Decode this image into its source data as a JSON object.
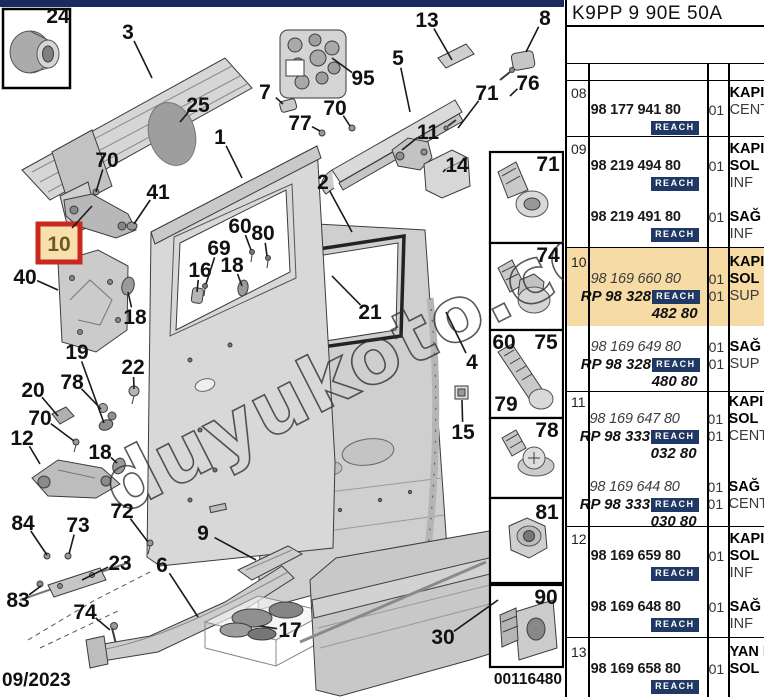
{
  "header": {
    "title": "K9PP 9 90E 50A"
  },
  "footer": {
    "date": "09/2023",
    "doc_number": "00116480"
  },
  "watermark": {
    "text": "duyukoto.com"
  },
  "badge": {
    "label": "REACH",
    "bg": "#1f3864",
    "fg": "#ffffff"
  },
  "colors": {
    "topbar": "#1b2a5e",
    "row_highlight": "#f6dba4",
    "selected_callout_border": "#c9281e",
    "selected_callout_bg": "#f7dfae",
    "reach_badge": "#1f3864"
  },
  "diagram": {
    "selected": {
      "label": "10"
    },
    "callouts": [
      {
        "label": "3",
        "x": 128,
        "y": 32,
        "tx": 152,
        "ty": 78
      },
      {
        "label": "95",
        "x": 363,
        "y": 78,
        "tx": 332,
        "ty": 58
      },
      {
        "label": "13",
        "x": 427,
        "y": 20,
        "tx": 452,
        "ty": 60
      },
      {
        "label": "8",
        "x": 545,
        "y": 18,
        "tx": 526,
        "ty": 52
      },
      {
        "label": "5",
        "x": 398,
        "y": 58,
        "tx": 410,
        "ty": 112
      },
      {
        "label": "71",
        "x": 487,
        "y": 93,
        "tx": 458,
        "ty": 128
      },
      {
        "label": "76",
        "x": 528,
        "y": 83,
        "tx": 510,
        "ty": 96
      },
      {
        "label": "25",
        "x": 198,
        "y": 105,
        "tx": 180,
        "ty": 122
      },
      {
        "label": "7",
        "x": 265,
        "y": 92,
        "tx": 283,
        "ty": 104
      },
      {
        "label": "77",
        "x": 300,
        "y": 123,
        "tx": 320,
        "ty": 131
      },
      {
        "label": "70",
        "x": 335,
        "y": 108,
        "tx": 350,
        "ty": 126
      },
      {
        "label": "11",
        "x": 428,
        "y": 132,
        "tx": 402,
        "ty": 150
      },
      {
        "label": "14",
        "x": 457,
        "y": 165,
        "tx": 443,
        "ty": 172
      },
      {
        "label": "1",
        "x": 220,
        "y": 137,
        "tx": 242,
        "ty": 178
      },
      {
        "label": "2",
        "x": 323,
        "y": 182,
        "tx": 352,
        "ty": 232
      },
      {
        "label": "41",
        "x": 158,
        "y": 192,
        "tx": 134,
        "ty": 224
      },
      {
        "label": "70",
        "x": 107,
        "y": 160,
        "tx": 96,
        "ty": 192
      },
      {
        "label": "40",
        "x": 25,
        "y": 277,
        "tx": 58,
        "ty": 290
      },
      {
        "label": "16",
        "x": 200,
        "y": 270,
        "tx": 197,
        "ty": 292
      },
      {
        "label": "18",
        "x": 232,
        "y": 265,
        "tx": 242,
        "ty": 286
      },
      {
        "label": "69",
        "x": 219,
        "y": 248,
        "tx": 206,
        "ty": 284
      },
      {
        "label": "60",
        "x": 240,
        "y": 226,
        "tx": 251,
        "ty": 250
      },
      {
        "label": "80",
        "x": 263,
        "y": 233,
        "tx": 267,
        "ty": 256
      },
      {
        "label": "21",
        "x": 370,
        "y": 312,
        "tx": 332,
        "ty": 276
      },
      {
        "label": "19",
        "x": 77,
        "y": 352,
        "tx": 104,
        "ty": 423
      },
      {
        "label": "22",
        "x": 133,
        "y": 367,
        "tx": 134,
        "ty": 389
      },
      {
        "label": "78",
        "x": 72,
        "y": 382,
        "tx": 101,
        "ty": 409
      },
      {
        "label": "20",
        "x": 33,
        "y": 390,
        "tx": 58,
        "ty": 416
      },
      {
        "label": "70",
        "x": 40,
        "y": 418,
        "tx": 74,
        "ty": 441
      },
      {
        "label": "12",
        "x": 22,
        "y": 438,
        "tx": 40,
        "ty": 464
      },
      {
        "label": "18",
        "x": 135,
        "y": 317,
        "tx": 128,
        "ty": 292
      },
      {
        "label": "18",
        "x": 100,
        "y": 452,
        "tx": 117,
        "ty": 463
      },
      {
        "label": "84",
        "x": 23,
        "y": 523,
        "tx": 47,
        "ty": 555
      },
      {
        "label": "73",
        "x": 78,
        "y": 525,
        "tx": 69,
        "ty": 554
      },
      {
        "label": "83",
        "x": 18,
        "y": 600,
        "tx": 41,
        "ty": 586
      },
      {
        "label": "23",
        "x": 120,
        "y": 563,
        "tx": 82,
        "ty": 580
      },
      {
        "label": "74",
        "x": 85,
        "y": 612,
        "tx": 110,
        "ty": 630
      },
      {
        "label": "72",
        "x": 122,
        "y": 511,
        "tx": 148,
        "ty": 542
      },
      {
        "label": "9",
        "x": 203,
        "y": 533,
        "tx": 256,
        "ty": 560
      },
      {
        "label": "6",
        "x": 162,
        "y": 565,
        "tx": 198,
        "ty": 617
      },
      {
        "label": "17",
        "x": 290,
        "y": 630,
        "tx": 260,
        "ty": 626
      },
      {
        "label": "30",
        "x": 443,
        "y": 637,
        "tx": 498,
        "ty": 600
      },
      {
        "label": "4",
        "x": 472,
        "y": 362,
        "tx": 446,
        "ty": 312
      },
      {
        "label": "15",
        "x": 463,
        "y": 432,
        "tx": 462,
        "ty": 400
      },
      {
        "label": "24",
        "x": 58,
        "y": 16
      },
      {
        "label": "71",
        "x": 548,
        "y": 164
      },
      {
        "label": "74",
        "x": 548,
        "y": 255
      },
      {
        "label": "60",
        "x": 504,
        "y": 342
      },
      {
        "label": "75",
        "x": 546,
        "y": 342
      },
      {
        "label": "79",
        "x": 506,
        "y": 404
      },
      {
        "label": "78",
        "x": 547,
        "y": 430
      },
      {
        "label": "81",
        "x": 547,
        "y": 512
      },
      {
        "label": "90",
        "x": 546,
        "y": 597
      }
    ]
  },
  "table": {
    "rows": [
      {
        "no": "08",
        "lines": [
          {
            "desc": "KAPI",
            "desc_bold": true
          },
          {
            "pn": "98 177 941 80",
            "qty": "01",
            "desc": "CENT"
          },
          {
            "badge": true
          }
        ]
      },
      {
        "no": "09",
        "lines": [
          {
            "desc": "KAPI",
            "desc_bold": true
          },
          {
            "pn": "98 219 494 80",
            "qty": "01",
            "desc": "SOL",
            "desc_bold": true
          },
          {
            "badge": true,
            "desc": "INF"
          },
          {
            "pn": "98 219 491 80",
            "qty": "01",
            "desc": "SAĞ",
            "desc_bold": true,
            "gap": true
          },
          {
            "badge": true,
            "desc": "INF"
          }
        ]
      },
      {
        "no": "10",
        "lines": [
          {
            "desc": "KAPI",
            "desc_bold": true,
            "highlight": true
          },
          {
            "pn": "98 169 660 80",
            "italic": true,
            "qty": "01",
            "desc": "SOL",
            "desc_bold": true,
            "highlight": true
          },
          {
            "rp": "RP 98 328",
            "badge": true,
            "qty": "01",
            "desc": "SUP",
            "highlight": true
          },
          {
            "rp2": "482 80",
            "highlight": true
          },
          {
            "pn": "98 169 649 80",
            "italic": true,
            "qty": "01",
            "desc": "SAĞ",
            "desc_bold": true,
            "gap": true
          },
          {
            "rp": "RP 98 328",
            "badge": true,
            "qty": "01",
            "desc": "SUP"
          },
          {
            "rp2": "480 80"
          }
        ]
      },
      {
        "no": "11",
        "lines": [
          {
            "desc": "KAPI",
            "desc_bold": true
          },
          {
            "pn": "98 169 647 80",
            "italic": true,
            "qty": "01",
            "desc": "SOL",
            "desc_bold": true
          },
          {
            "rp": "RP 98 333",
            "badge": true,
            "qty": "01",
            "desc": "CENT"
          },
          {
            "rp2": "032 80"
          },
          {
            "pn": "98 169 644 80",
            "italic": true,
            "qty": "01",
            "desc": "SAĞ",
            "desc_bold": true,
            "gap": true
          },
          {
            "rp": "RP 98 333",
            "badge": true,
            "qty": "01",
            "desc": "CENT"
          },
          {
            "rp2": "030 80"
          }
        ]
      },
      {
        "no": "12",
        "lines": [
          {
            "desc": "KAPI",
            "desc_bold": true
          },
          {
            "pn": "98 169 659 80",
            "qty": "01",
            "desc": "SOL",
            "desc_bold": true
          },
          {
            "badge": true,
            "desc": "INF"
          },
          {
            "pn": "98 169 648 80",
            "qty": "01",
            "desc": "SAĞ",
            "desc_bold": true,
            "gap": true
          },
          {
            "badge": true,
            "desc": "INF"
          }
        ]
      },
      {
        "no": "13",
        "lines": [
          {
            "desc": "YAN K",
            "desc_bold": true
          },
          {
            "pn": "98 169 658 80",
            "qty": "01",
            "desc": "SOL",
            "desc_bold": true
          },
          {
            "badge": true
          }
        ]
      }
    ]
  }
}
